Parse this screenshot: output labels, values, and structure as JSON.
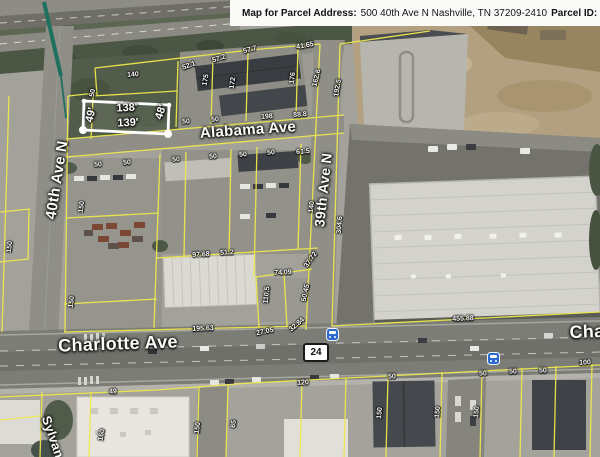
{
  "header": {
    "map_label": "Map for Parcel Address:",
    "address": "500 40th Ave N Nashville, TN 37209-2410",
    "parcel_id_label": "Parcel ID:",
    "parcel_id_value": "091"
  },
  "subject_parcel": {
    "width_top": "138'",
    "width_bottom": "139'",
    "depth_left": "49'",
    "depth_right": "48'"
  },
  "highway_shield": {
    "route": "24"
  },
  "street_labels": [
    {
      "text": "40th Ave N",
      "x": 57,
      "y": 180,
      "rot": -81,
      "size": 15
    },
    {
      "text": "Alabama Ave",
      "x": 248,
      "y": 130,
      "rot": -4,
      "size": 15
    },
    {
      "text": "39th Ave N",
      "x": 323,
      "y": 190,
      "rot": -84,
      "size": 14
    },
    {
      "text": "Charlotte Ave",
      "x": 118,
      "y": 344,
      "rot": -2,
      "size": 18
    },
    {
      "text": "Cha",
      "x": 587,
      "y": 332,
      "rot": -2,
      "size": 18
    },
    {
      "text": "Sylvan",
      "x": 53,
      "y": 437,
      "rot": 71,
      "size": 13
    }
  ],
  "parcel_dim_labels": [
    {
      "text": "138'",
      "x": 127,
      "y": 108,
      "rot": -3
    },
    {
      "text": "139'",
      "x": 128,
      "y": 123,
      "rot": -3
    },
    {
      "text": "49'",
      "x": 91,
      "y": 115,
      "rot": -76
    },
    {
      "text": "48'",
      "x": 161,
      "y": 112,
      "rot": -72
    }
  ],
  "dimension_labels": [
    {
      "text": "140",
      "x": 133,
      "y": 75,
      "rot": -4
    },
    {
      "text": "50",
      "x": 93,
      "y": 93,
      "rot": -80
    },
    {
      "text": "52.1",
      "x": 189,
      "y": 66,
      "rot": -20
    },
    {
      "text": "175",
      "x": 206,
      "y": 80,
      "rot": -80
    },
    {
      "text": "57.2",
      "x": 219,
      "y": 59,
      "rot": -18
    },
    {
      "text": "172",
      "x": 233,
      "y": 83,
      "rot": -82
    },
    {
      "text": "57.7",
      "x": 250,
      "y": 50,
      "rot": -15
    },
    {
      "text": "176",
      "x": 293,
      "y": 78,
      "rot": -84
    },
    {
      "text": "41.65",
      "x": 305,
      "y": 46,
      "rot": -10
    },
    {
      "text": "162.6",
      "x": 317,
      "y": 78,
      "rot": -76
    },
    {
      "text": "192.5",
      "x": 338,
      "y": 88,
      "rot": -80
    },
    {
      "text": "50",
      "x": 186,
      "y": 122,
      "rot": -4
    },
    {
      "text": "50",
      "x": 215,
      "y": 120,
      "rot": -4
    },
    {
      "text": "198",
      "x": 267,
      "y": 117,
      "rot": -4
    },
    {
      "text": "88.8",
      "x": 300,
      "y": 115,
      "rot": -4
    },
    {
      "text": "50",
      "x": 98,
      "y": 165,
      "rot": -4
    },
    {
      "text": "50",
      "x": 127,
      "y": 163,
      "rot": -4
    },
    {
      "text": "50",
      "x": 176,
      "y": 160,
      "rot": -4
    },
    {
      "text": "50",
      "x": 213,
      "y": 157,
      "rot": -4
    },
    {
      "text": "50",
      "x": 243,
      "y": 155,
      "rot": -4
    },
    {
      "text": "50",
      "x": 271,
      "y": 153,
      "rot": -4
    },
    {
      "text": "61.5",
      "x": 303,
      "y": 152,
      "rot": -4
    },
    {
      "text": "150",
      "x": 82,
      "y": 207,
      "rot": -82
    },
    {
      "text": "150",
      "x": 10,
      "y": 247,
      "rot": -82
    },
    {
      "text": "150",
      "x": 72,
      "y": 302,
      "rot": -82
    },
    {
      "text": "97.68",
      "x": 201,
      "y": 255,
      "rot": -3
    },
    {
      "text": "51.2",
      "x": 227,
      "y": 253,
      "rot": -3
    },
    {
      "text": "74.09",
      "x": 283,
      "y": 273,
      "rot": -3
    },
    {
      "text": "110.5",
      "x": 267,
      "y": 295,
      "rot": -84
    },
    {
      "text": "50.45",
      "x": 306,
      "y": 293,
      "rot": -78
    },
    {
      "text": "37.72",
      "x": 311,
      "y": 260,
      "rot": -55
    },
    {
      "text": "140",
      "x": 312,
      "y": 207,
      "rot": -84
    },
    {
      "text": "304.6",
      "x": 340,
      "y": 225,
      "rot": -86
    },
    {
      "text": "195.63",
      "x": 203,
      "y": 329,
      "rot": -2
    },
    {
      "text": "27.05",
      "x": 265,
      "y": 332,
      "rot": -12
    },
    {
      "text": "32.84",
      "x": 297,
      "y": 325,
      "rot": -40
    },
    {
      "text": "455.88",
      "x": 463,
      "y": 319,
      "rot": -2
    },
    {
      "text": "100",
      "x": 585,
      "y": 363,
      "rot": -2
    },
    {
      "text": "50",
      "x": 483,
      "y": 374,
      "rot": -2
    },
    {
      "text": "50",
      "x": 513,
      "y": 372,
      "rot": -2
    },
    {
      "text": "50",
      "x": 543,
      "y": 371,
      "rot": -2
    },
    {
      "text": "50",
      "x": 392,
      "y": 377,
      "rot": -2
    },
    {
      "text": "120",
      "x": 303,
      "y": 383,
      "rot": -2
    },
    {
      "text": "49",
      "x": 113,
      "y": 392,
      "rot": -2
    },
    {
      "text": "150",
      "x": 380,
      "y": 413,
      "rot": -85
    },
    {
      "text": "150",
      "x": 438,
      "y": 412,
      "rot": -85
    },
    {
      "text": "150",
      "x": 477,
      "y": 412,
      "rot": -85
    },
    {
      "text": "150",
      "x": 198,
      "y": 428,
      "rot": -83
    },
    {
      "text": "65",
      "x": 234,
      "y": 424,
      "rot": -83
    },
    {
      "text": "160",
      "x": 102,
      "y": 435,
      "rot": -80
    }
  ],
  "transit_stops": [
    {
      "x": 327,
      "y": 329
    },
    {
      "x": 488,
      "y": 353
    }
  ],
  "colors": {
    "parcel_line": "#eee84e",
    "subject_highlight": "#ffffff",
    "annotation_line": "#20705f"
  }
}
